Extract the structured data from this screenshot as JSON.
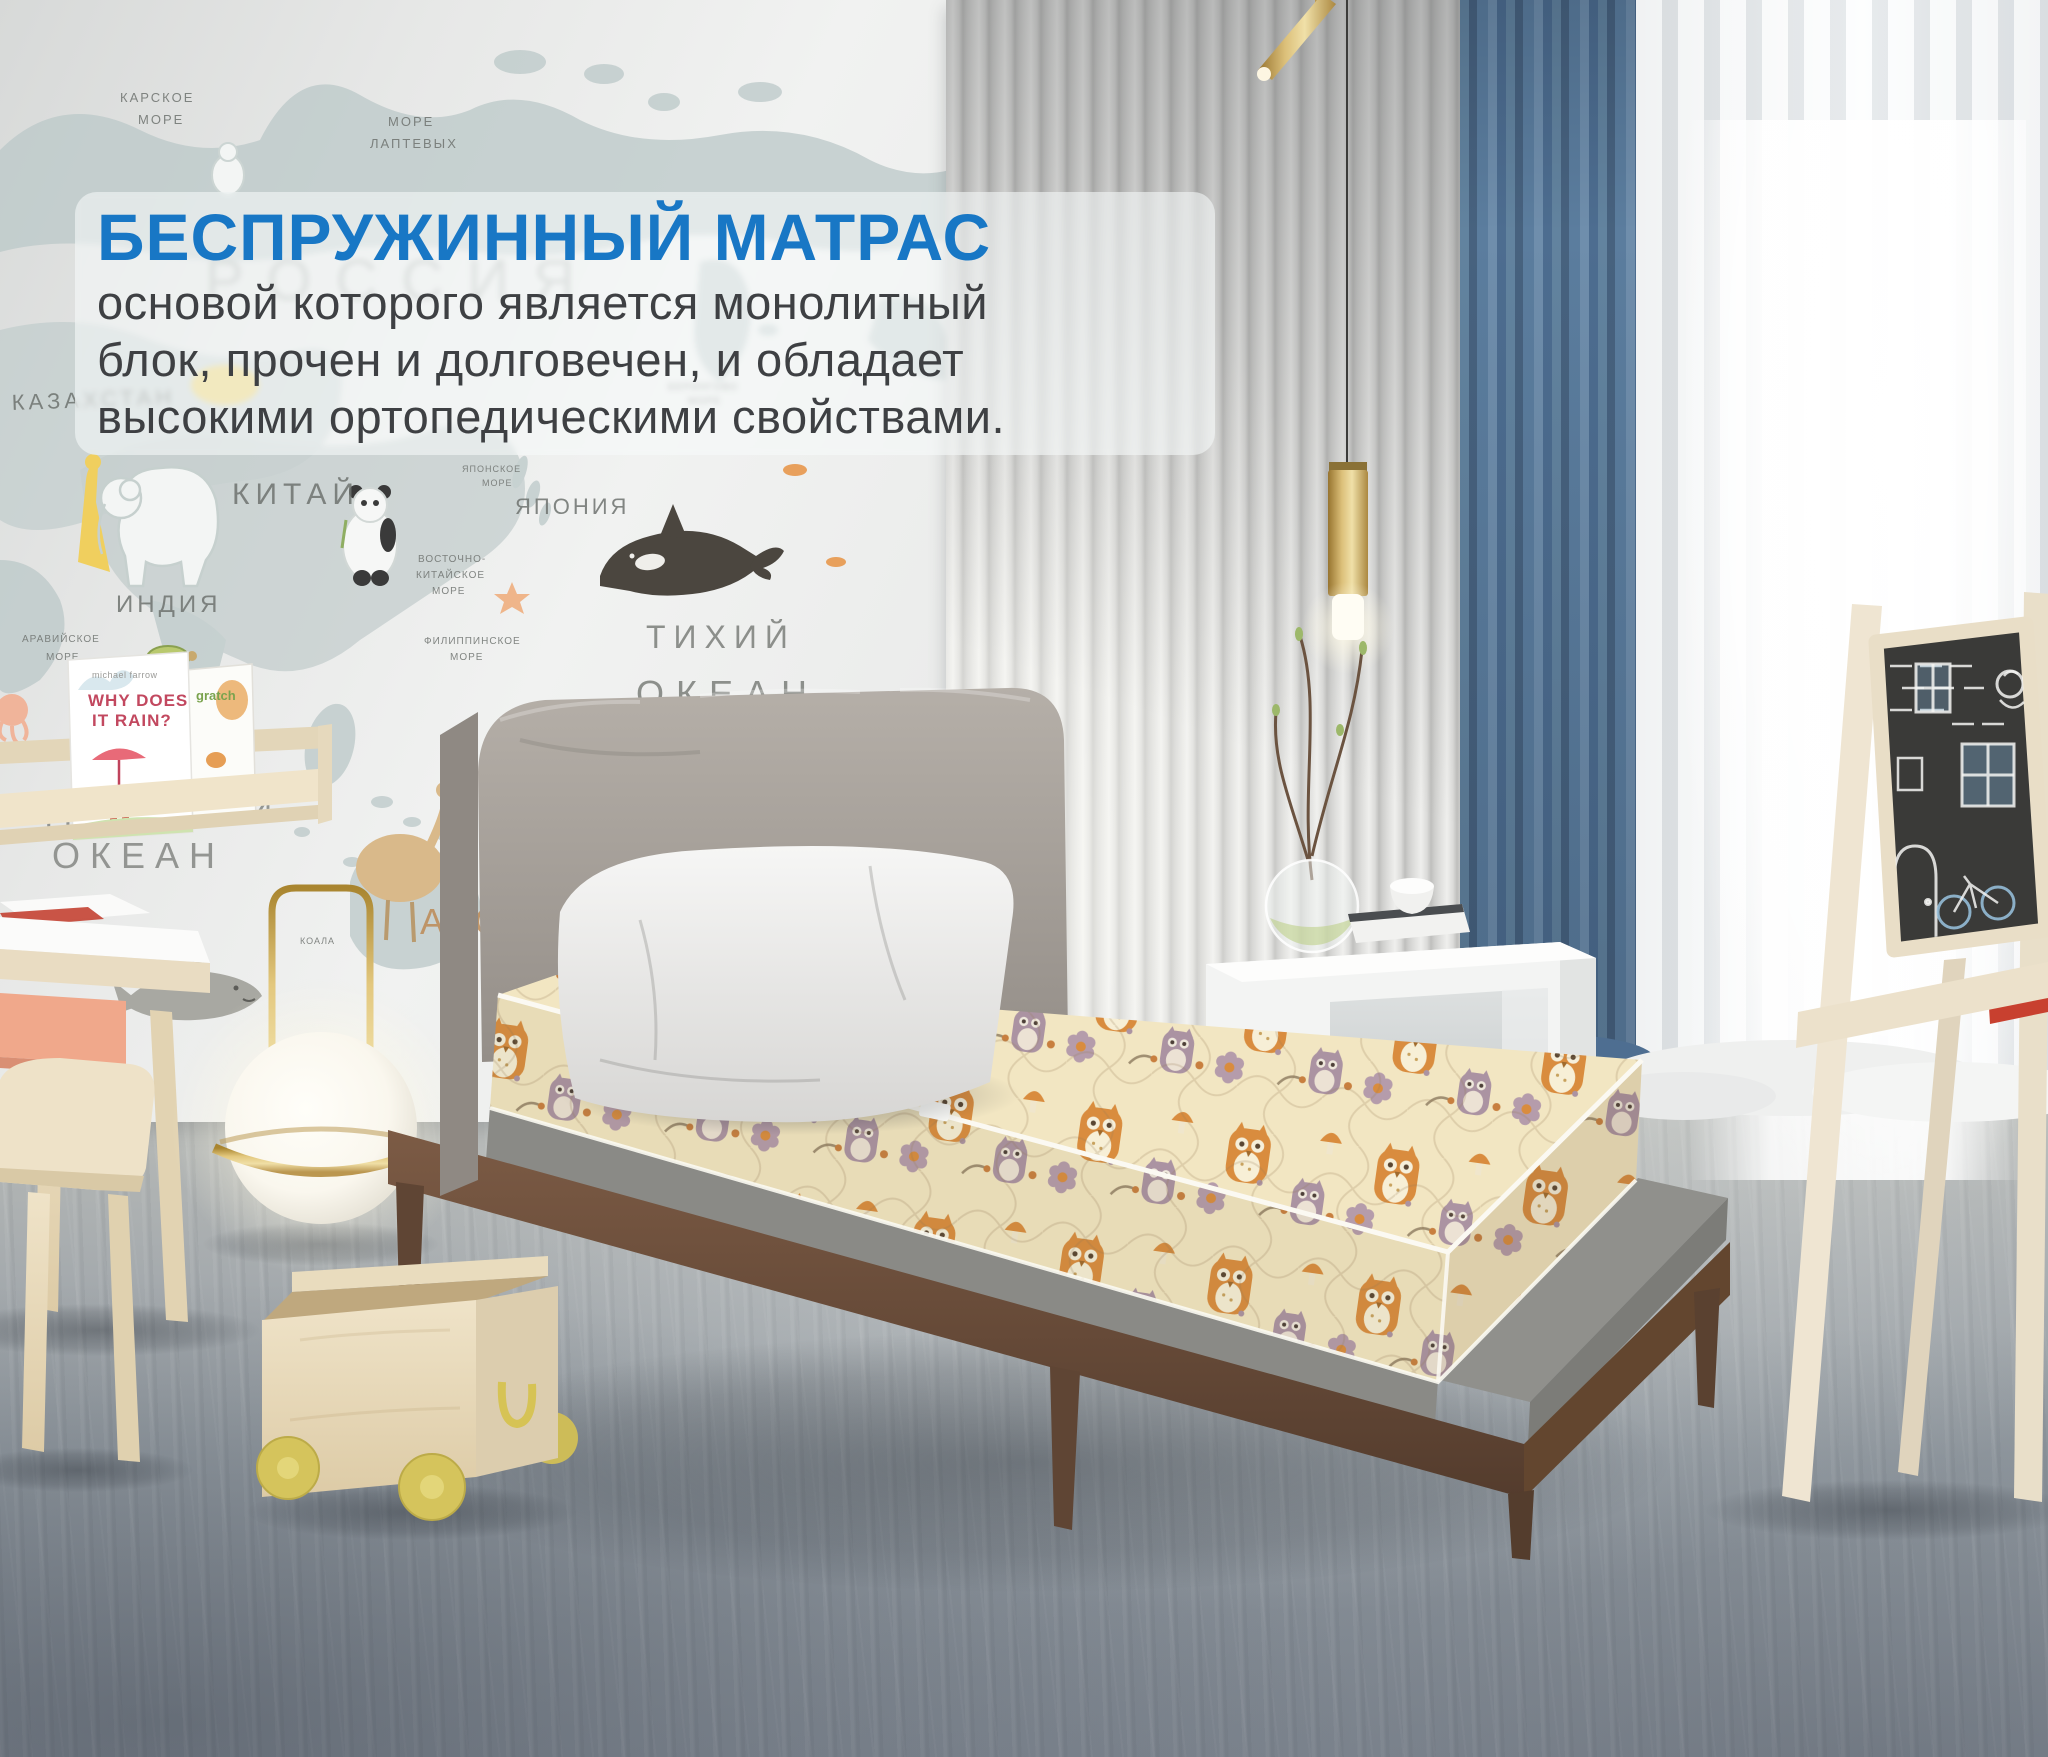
{
  "overlay": {
    "title": "БЕСПРУЖИННЫЙ МАТРАС",
    "line1": "основой которого является монолитный",
    "line2": "блок, прочен и долговечен, и обладает",
    "line3": "высокими ортопедическими свойствами."
  },
  "mural": {
    "labels": {
      "karskoe1": "КАРСКОЕ",
      "karskoe2": "МОРЕ",
      "laptev1": "МОРЕ",
      "laptev2": "ЛАПТЕВЫХ",
      "rossiya": "РОССИЯ",
      "kazakhstan": "КАЗАХСТАН",
      "kitay": "КИТАЙ",
      "yaponiya": "ЯПОНИЯ",
      "indiya": "ИНДИЯ",
      "araviyskoe1": "АРАВИЙСКОЕ",
      "araviyskoe2": "МОРЕ",
      "beringovo1": "БЕРИНГОВО",
      "beringovo2": "МОРЕ",
      "vostochno1": "ВОСТОЧНО-",
      "vostochno2": "КИТАЙСКОЕ",
      "vostochno3": "МОРЕ",
      "yaponskoe1": "ЯПОНСКОЕ",
      "yaponskoe2": "МОРЕ",
      "filippinskoe1": "ФИЛИППИНСКОЕ",
      "filippinskoe2": "МОРЕ",
      "tikhiy": "ТИХИЙ",
      "okean_tikhiy": "ОКЕАН",
      "indiyskiy": "ИНДИЙСКИЙ",
      "okean_indiyskiy": "ОКЕАН",
      "koala": "КОАЛА",
      "abc": "ABC"
    }
  },
  "bookshelf": {
    "book1_author": "michael farrow",
    "book1_title1": "WHY DOES",
    "book1_title2": "IT RAIN?",
    "book2_title": "gratch"
  },
  "palette": {
    "accent_blue": "#1877c5",
    "body_text": "#3e4043",
    "panel_bg": "rgba(246,249,249,0.58)",
    "curtain_blue": "#5b7d9e",
    "mattress_cream": "#f2e6c2",
    "owl_orange": "#d98c3e",
    "owl_mauve": "#ab93a2",
    "wood_walnut": "#6b4e3b",
    "wood_birch": "#ecdfc4",
    "wall_gray": "#d8dad8",
    "floor_gray": "#9aa1a7"
  }
}
